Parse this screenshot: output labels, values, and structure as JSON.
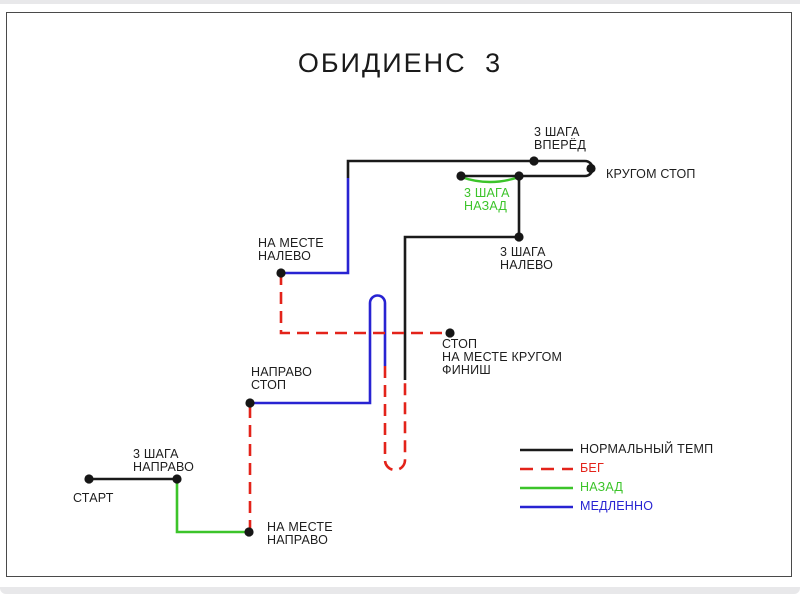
{
  "title": "ОБИДИЕНС 3",
  "colors": {
    "normal": "#1a1a1a",
    "run": "#e3231a",
    "back": "#3cc42a",
    "slow": "#2823d2",
    "dot": "#161616",
    "frame": "#4a4a4a"
  },
  "labels": {
    "steps_forward": "3 ШАГА\nВПЕРЁД",
    "around_stop": "КРУГОМ СТОП",
    "steps_back": "3 ШАГА\nНАЗАД",
    "steps_left": "3 ШАГА\nНАЛЕВО",
    "in_place_left": "НА МЕСТЕ\nНАЛЕВО",
    "stop_finish": "СТОП\nНА МЕСТЕ КРУГОМ\nФИНИШ",
    "right_stop": "НАПРАВО\nСТОП",
    "steps_right": "3 ШАГА\nНАПРАВО",
    "start": "СТАРТ",
    "in_place_right": "НА МЕСТЕ\nНАПРАВО"
  },
  "legend": {
    "items": [
      {
        "label": "НОРМАЛЬНЫЙ ТЕМП",
        "key": "normal",
        "style": "solid"
      },
      {
        "label": "БЕГ",
        "key": "run",
        "style": "dashed"
      },
      {
        "label": "НАЗАД",
        "key": "back",
        "style": "solid"
      },
      {
        "label": "МЕДЛЕННО",
        "key": "slow",
        "style": "solid"
      }
    ]
  }
}
